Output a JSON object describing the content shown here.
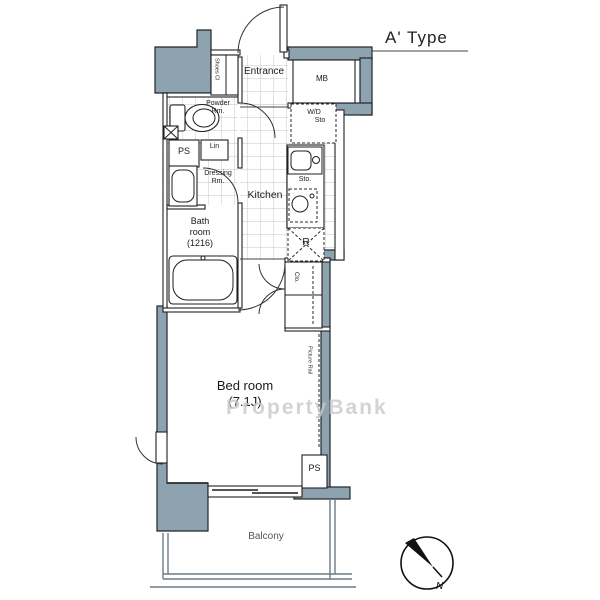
{
  "title": "A' Type",
  "colors": {
    "wall_fill": "#8da3b0",
    "line": "#1f1f1f",
    "watermark": "#c9c9c9"
  },
  "watermark": "PropertyBank",
  "compass": {
    "label": "N"
  },
  "rooms": {
    "entrance": {
      "label": "Entrance"
    },
    "shoes_closet": {
      "label": "Shoes Cl"
    },
    "meter_box": {
      "label": "MB"
    },
    "washer_dryer_storage": {
      "line1": "W/D",
      "line2": "Sto"
    },
    "powder_room": {
      "line1": "Powder",
      "line2": "Rm."
    },
    "pipe_space_upper": {
      "label": "PS"
    },
    "linen": {
      "label": "Lin"
    },
    "dressing_room": {
      "line1": "Dressing",
      "line2": "Rm."
    },
    "kitchen": {
      "label": "Kitchen"
    },
    "kitchen_storage": {
      "label": "Sto."
    },
    "refrigerator": {
      "label": "R"
    },
    "bathroom": {
      "line1": "Bath",
      "line2": "room",
      "line3": "(1216)"
    },
    "closet": {
      "label": "Clo."
    },
    "bedroom": {
      "line1": "Bed room",
      "line2": "(7.1J)"
    },
    "picture_rail": {
      "label": "Picture Rail"
    },
    "pipe_space_lower": {
      "label": "PS"
    },
    "balcony": {
      "label": "Balcony"
    }
  }
}
